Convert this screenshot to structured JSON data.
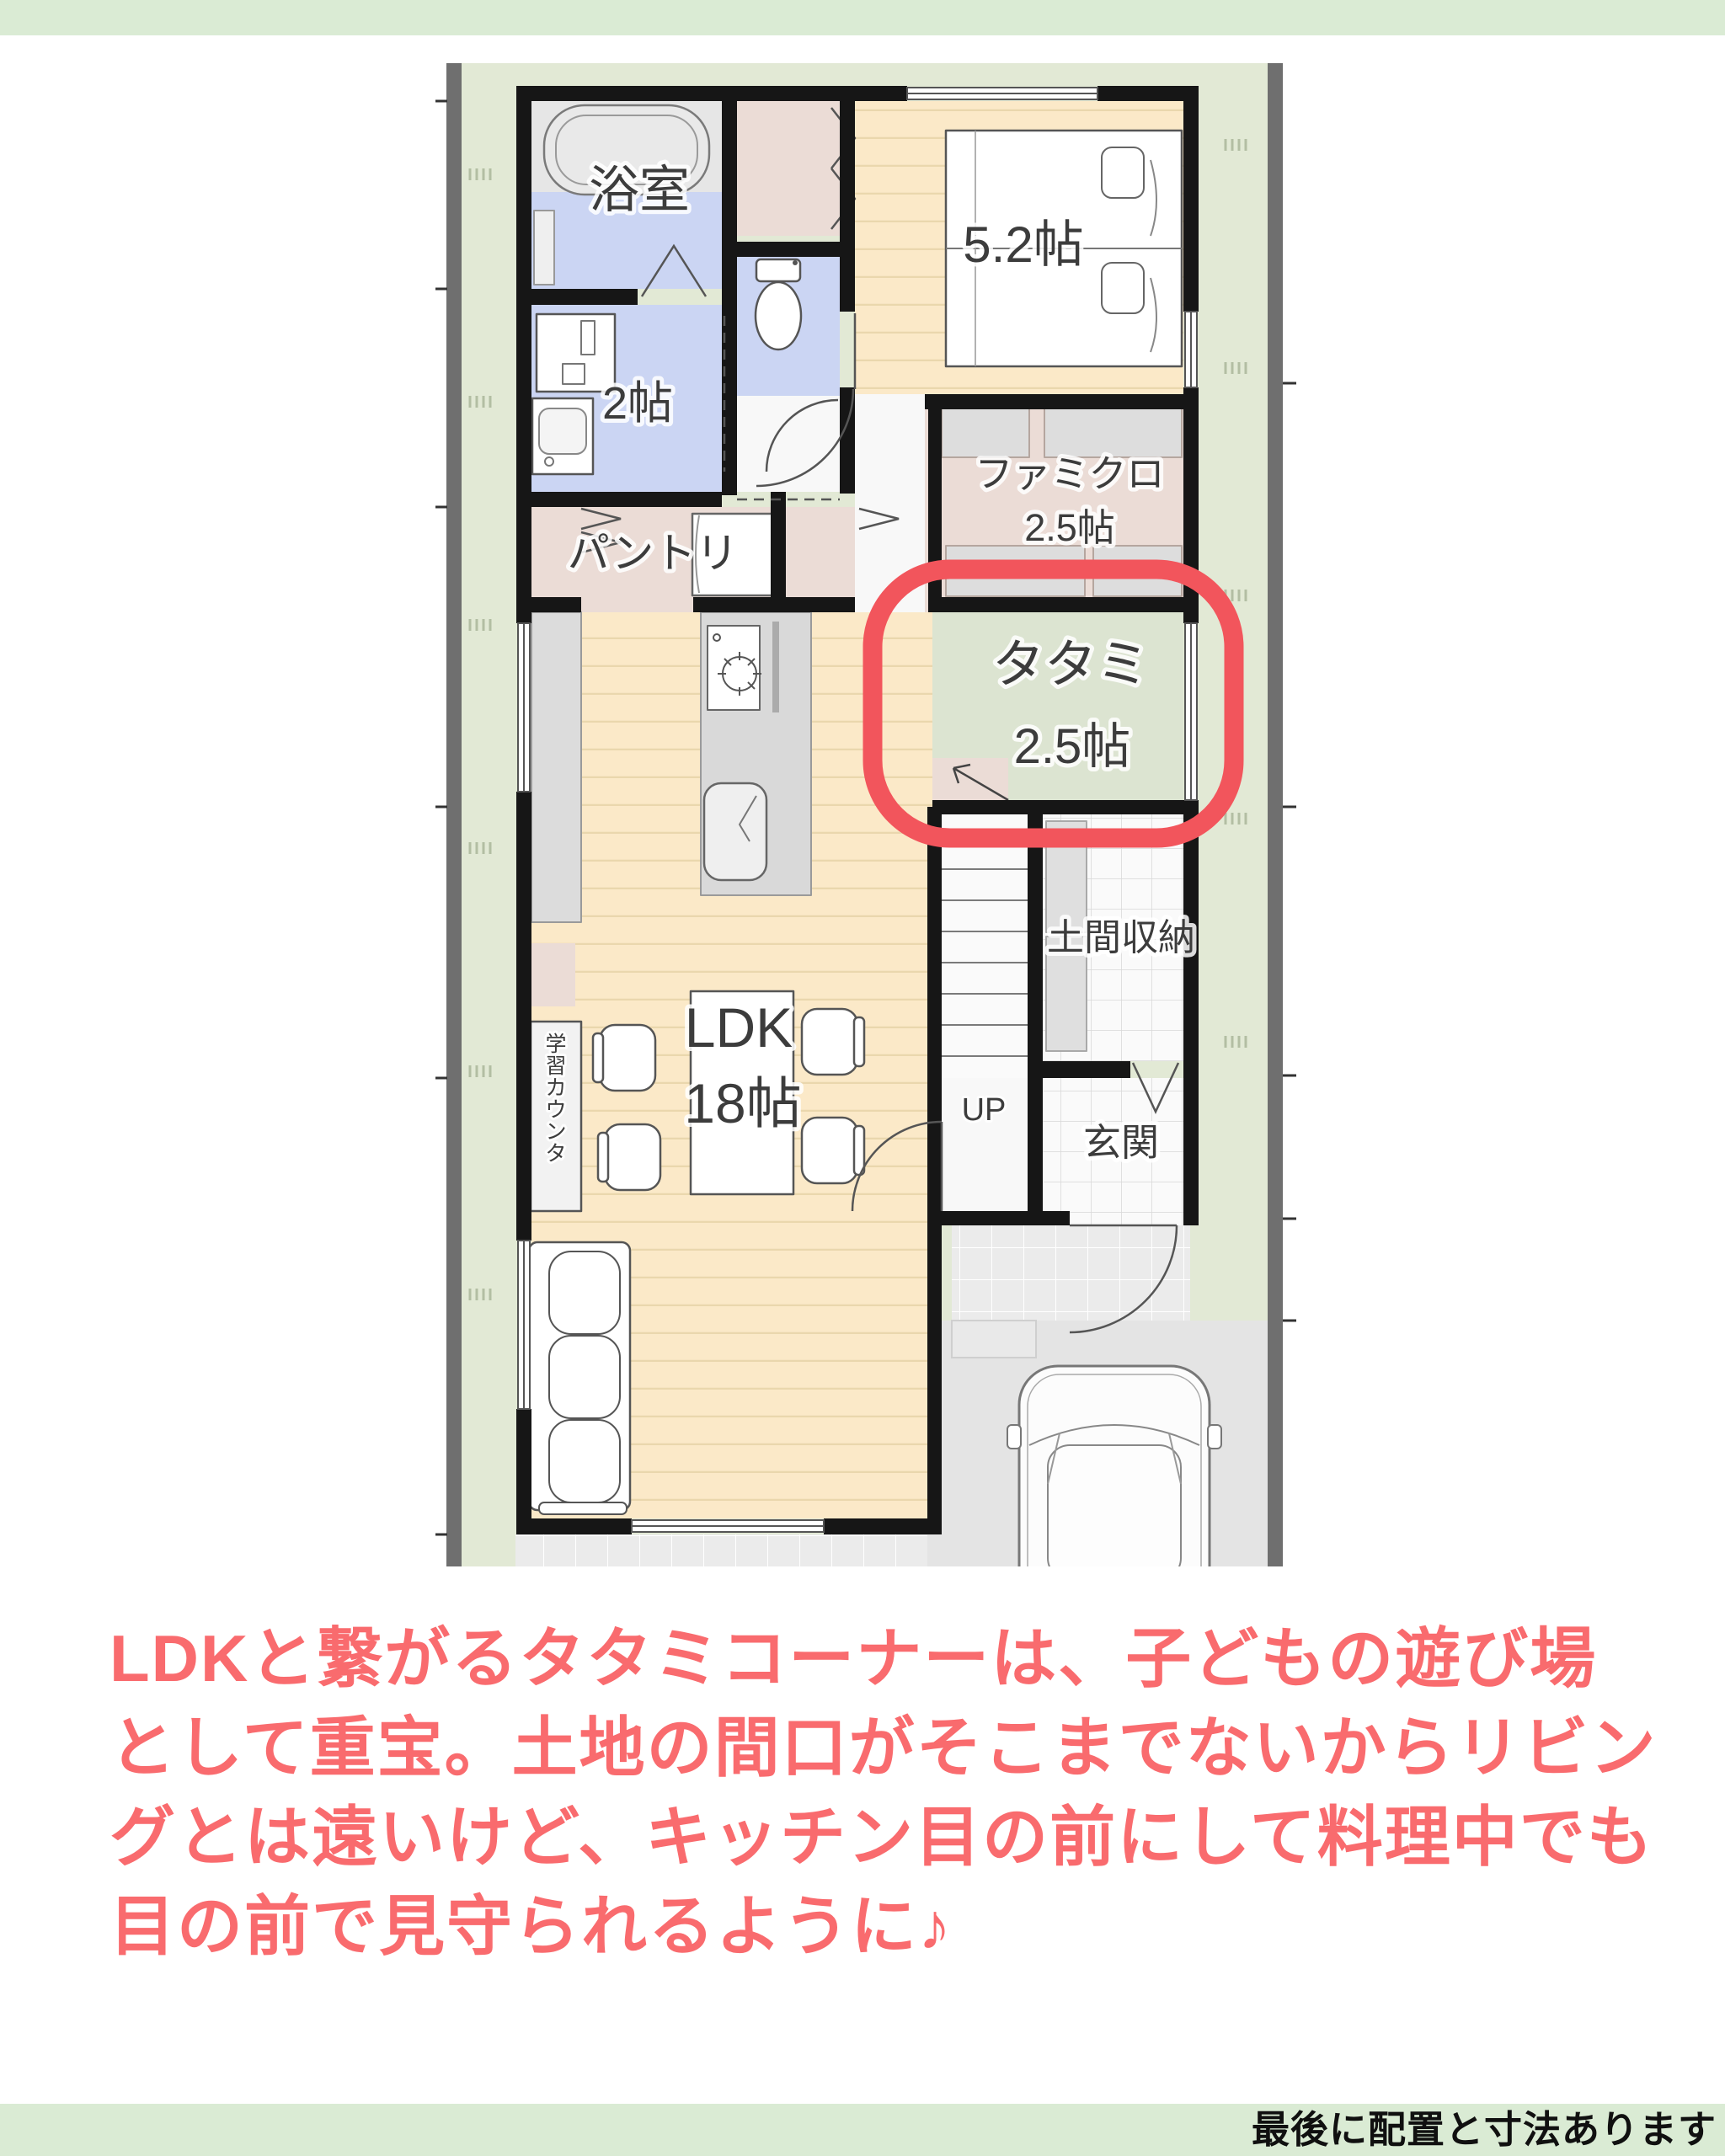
{
  "banners": {
    "top_color": "#DAEBD4",
    "bottom": {
      "bg": "#DAEBD4",
      "text": "最後に配置と寸法あります",
      "text_color": "#101010"
    }
  },
  "caption": {
    "color": "#F96B6E",
    "lines": [
      "LDKと繋がるタタミコーナーは、子どもの遊び場",
      "として重宝。土地の間口がそこまでないからリビン",
      "グとは遠いけど、キッチン目の前にして料理中でも",
      "目の前で見守られるように♪"
    ]
  },
  "floorplan": {
    "site_color": "#E2E9D5",
    "wall_color": "#161616",
    "highlight_color": "#F2555C",
    "floor_colors": {
      "wood": "#FBE9C8",
      "wet_blue": "#CBD5F3",
      "closet_pink": "#EBDCD6",
      "tatami_green": "#DCE4D1",
      "bath_gray": "#E6E6E6",
      "hall_white": "#F8F8F8"
    },
    "labels": {
      "bath": "浴室",
      "washroom": "2帖",
      "pantry": "パントリ",
      "bedroom": "5.2帖",
      "famiclo": "ファミクロ",
      "famiclo_size": "2.5帖",
      "tatami": "タタミ",
      "tatami_size": "2.5帖",
      "doma": "土間収納",
      "up": "UP",
      "genkan": "玄関",
      "ldk": "LDK",
      "ldk_size": "18帖",
      "counter": "学習カウンタ"
    }
  }
}
